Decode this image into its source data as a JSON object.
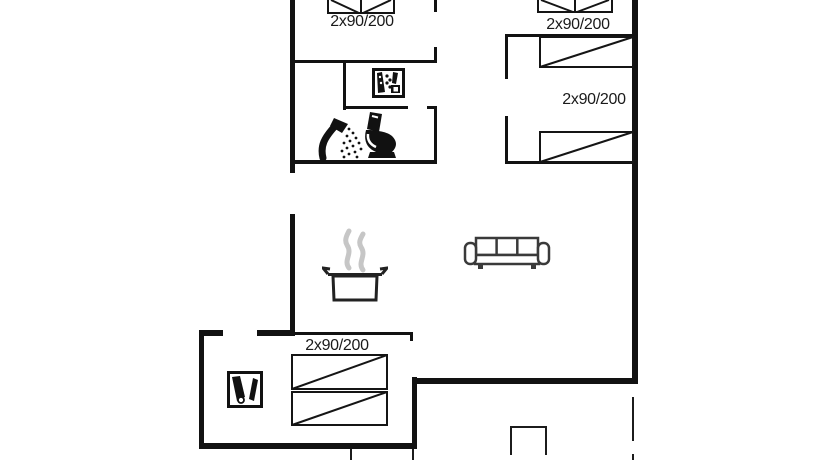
{
  "floor_plan": {
    "background": "#ffffff",
    "wall_color": "#121212",
    "text_color": "#1a1a1a",
    "steam_color": "#c6c6c6",
    "sofa_outline_color": "#3a3a3a",
    "bed_labels": {
      "top_left_bedroom": "2x90/200",
      "top_right_bedroom": "2x90/200",
      "right_bedroom": "2x90/200",
      "bunk_bedroom": "2x90/200"
    },
    "icons": [
      "double-bed-foot-icon",
      "double-bed-foot-icon",
      "single-bed-icon",
      "single-bed-icon",
      "bunk-bed-icon",
      "dishwasher-icon",
      "shower-icon",
      "toilet-icon",
      "cooking-pot-icon",
      "sofa-icon",
      "sauna-icon"
    ]
  }
}
